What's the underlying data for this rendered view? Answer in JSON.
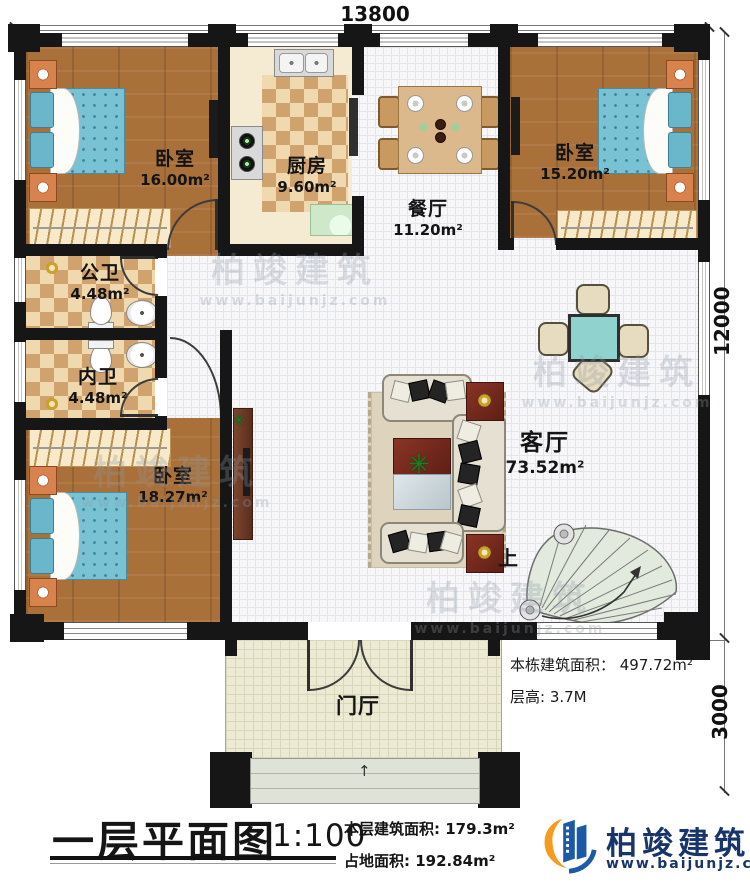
{
  "dims": {
    "top": "13800",
    "right_main": "12000",
    "right_porch": "3000"
  },
  "rooms": {
    "bedroom_tl": {
      "name": "卧室",
      "area": "16.00m²"
    },
    "kitchen": {
      "name": "厨房",
      "area": "9.60m²"
    },
    "dining": {
      "name": "餐厅",
      "area": "11.20m²"
    },
    "bedroom_tr": {
      "name": "卧室",
      "area": "15.20m²"
    },
    "bath_public": {
      "name": "公卫",
      "area": "4.48m²"
    },
    "bath_private": {
      "name": "内卫",
      "area": "4.48m²"
    },
    "bedroom_bl": {
      "name": "卧室",
      "area": "18.27m²"
    },
    "living": {
      "name": "客厅",
      "area": "73.52m²"
    },
    "foyer": {
      "name": "门厅"
    }
  },
  "annotations": {
    "building_area": "本栋建筑面积： 497.72m²",
    "floor_height": "层高: 3.7M",
    "stairs_up": "上"
  },
  "footer": {
    "title": "一层平面图",
    "scale": "1:100",
    "floor_area": "本层建筑面积: 179.3m²",
    "footprint_area": "占地面积: 192.84m²"
  },
  "brand": {
    "name": "柏竣建筑",
    "website": "www.baijunjz.com"
  },
  "watermark": {
    "name": "柏竣建筑",
    "website": "www.baijunjz.com"
  },
  "colors": {
    "wall": "#161616",
    "wood_floor": "#a9703a",
    "checker": "#d0a26d",
    "tile": "#f7f7fa",
    "bed": "#79c2d4",
    "accent_redwood": "#6e2a1e",
    "stair_tread": "#dfe8da",
    "card_table": "#8fd2ce",
    "brand_blue": "#1c5aa6",
    "brand_orange": "#f59b1e"
  }
}
